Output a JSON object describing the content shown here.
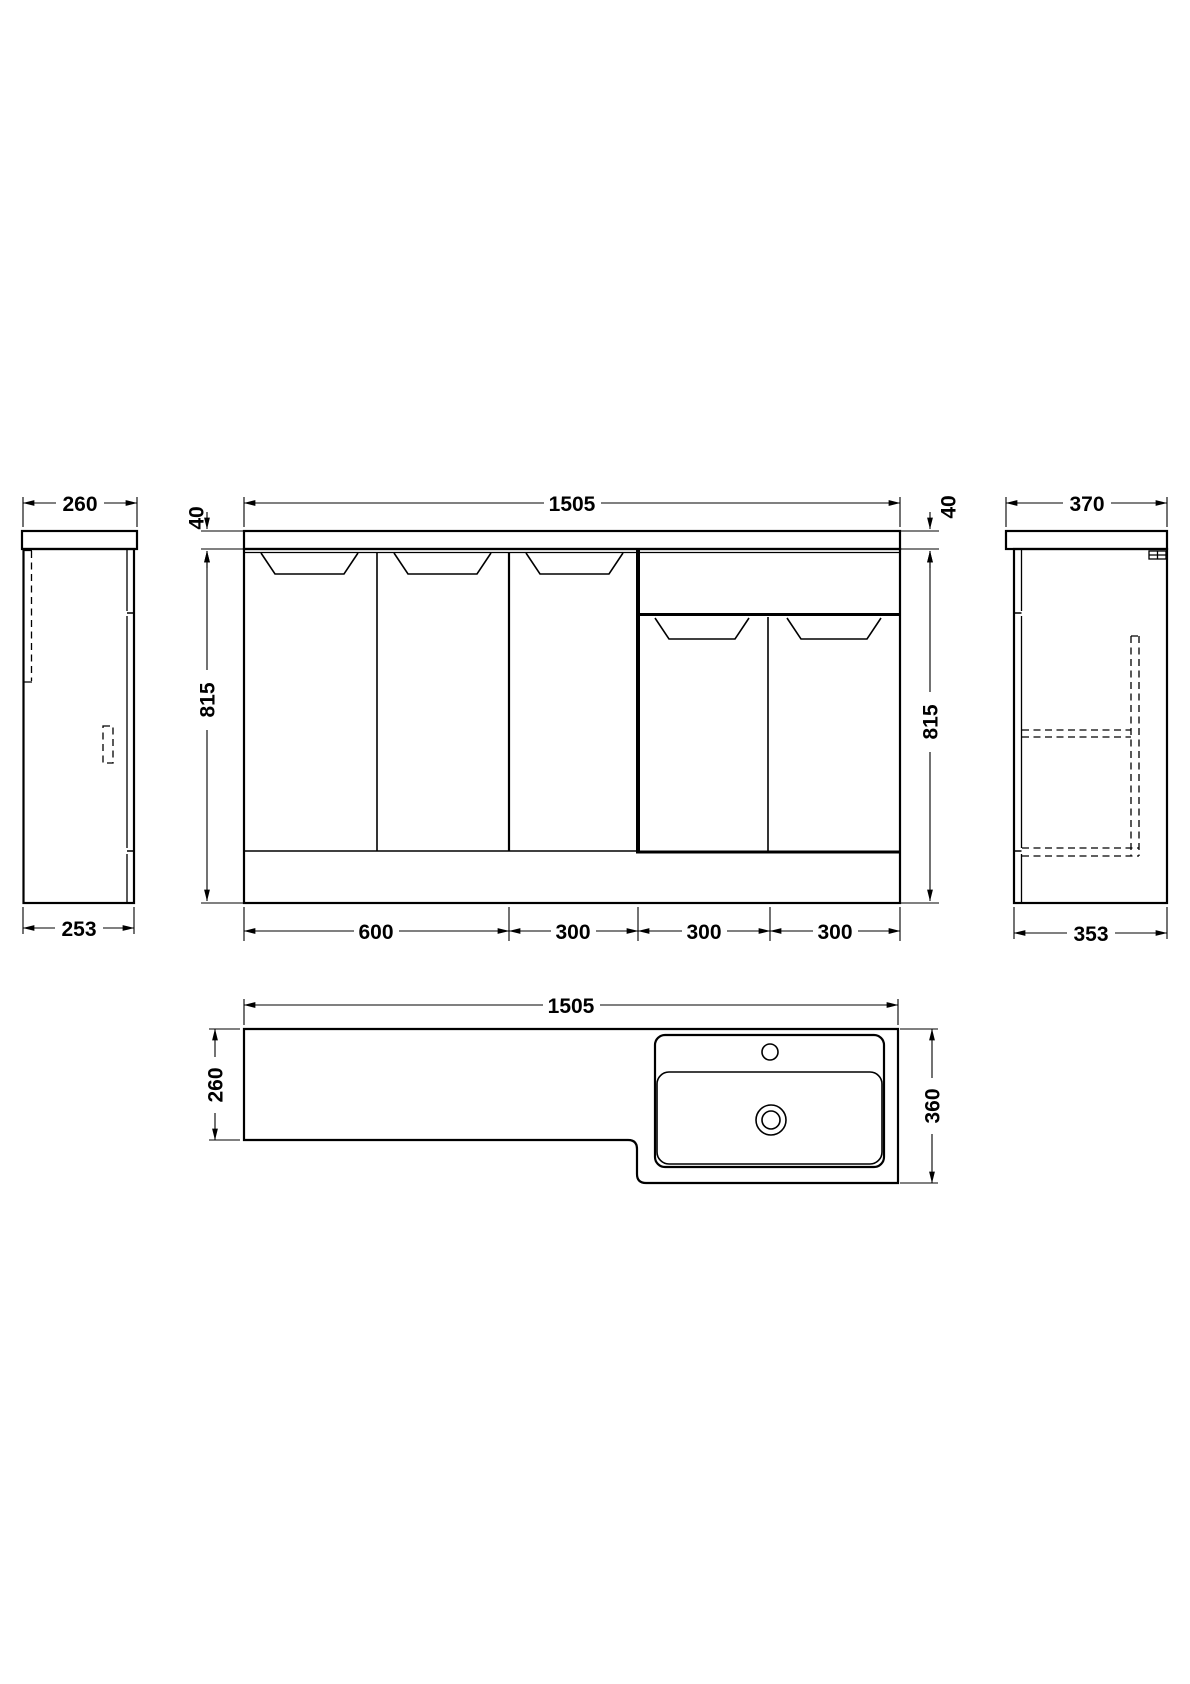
{
  "drawing": {
    "title": "vanity-unit-technical-drawing",
    "line_color": "#000000",
    "background": "#ffffff",
    "left_view": {
      "worktop_depth": "260",
      "cabinet_depth": "253"
    },
    "front_view": {
      "overall_width": "1505",
      "worktop_thickness_left": "40",
      "worktop_thickness_right": "40",
      "height_left": "815",
      "height_right": "815",
      "unit_widths": [
        "600",
        "300",
        "300",
        "300"
      ]
    },
    "right_view": {
      "worktop_depth": "370",
      "cabinet_depth": "353"
    },
    "plan_view": {
      "overall_width": "1505",
      "left_depth": "260",
      "right_depth": "360"
    }
  }
}
